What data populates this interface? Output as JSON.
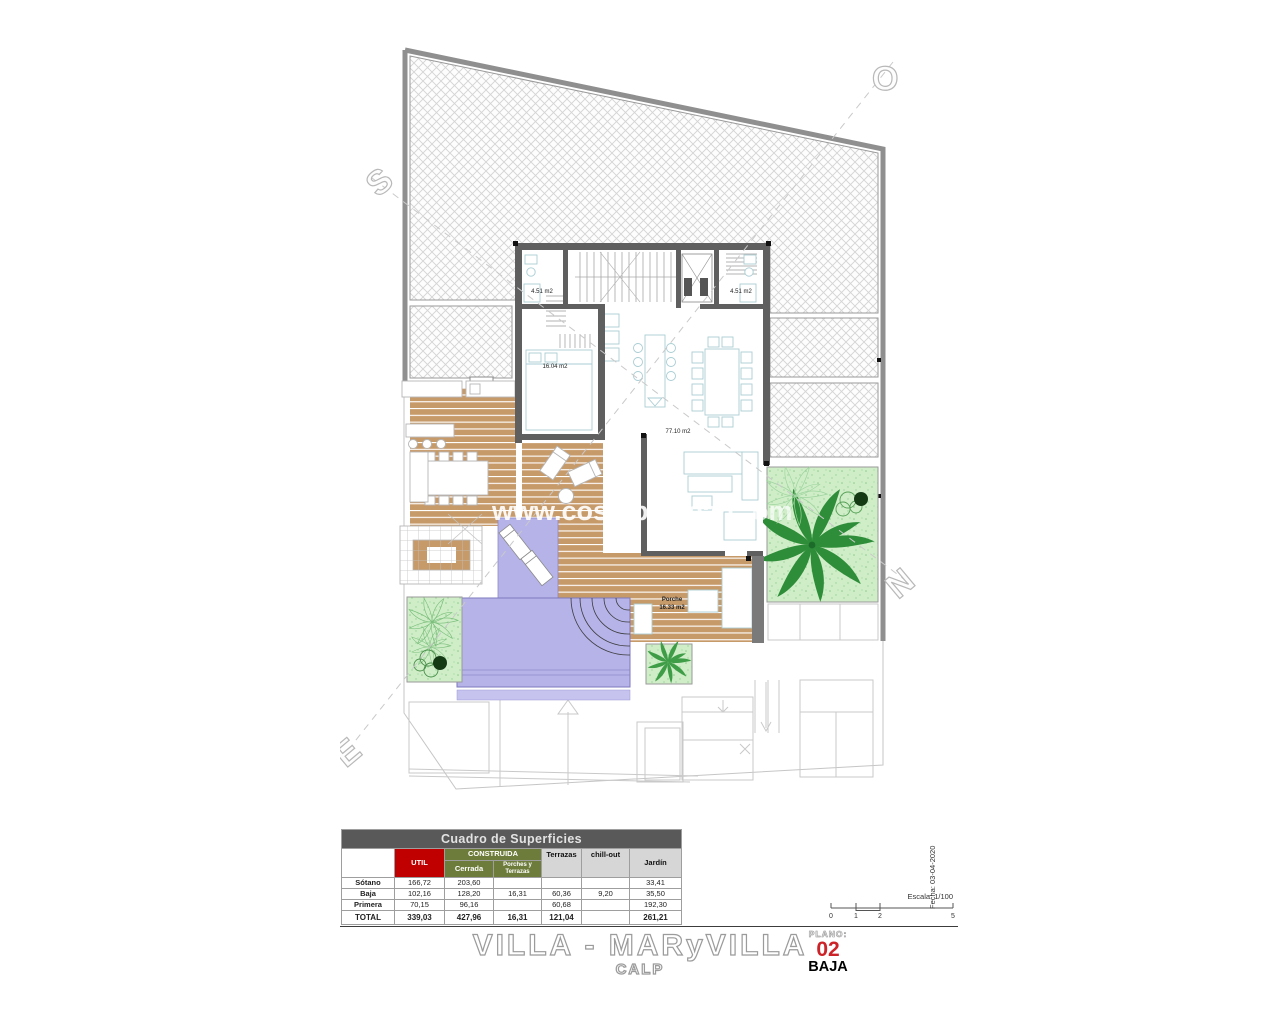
{
  "plan": {
    "compass": {
      "s": "S",
      "o": "O",
      "n": "N",
      "e": "E"
    },
    "labels": {
      "bath_left": "4.51 m2",
      "bath_right": "4.51 m2",
      "bedroom": "16.04 m2",
      "living": "77.10 m2",
      "porch_name": "Porche",
      "porch_area": "16.33 m2"
    },
    "watermark": {
      "part1": "www.costablancah",
      "part2": "om"
    }
  },
  "table": {
    "title": "Cuadro de Superficies",
    "headers": {
      "util": "UTIL",
      "construida": "CONSTRUIDA",
      "cerrada": "Cerrada",
      "porches_line1": "Porches y",
      "porches_line2": "Terrazas",
      "terrazas": "Terrazas",
      "chill_out": "chill-out",
      "jardin": "Jardín"
    },
    "rows": [
      {
        "label": "Sótano",
        "util": "166,72",
        "cerrada": "203,60",
        "porches": "",
        "terrazas": "",
        "chill_out": "",
        "jardin": "33,41"
      },
      {
        "label": "Baja",
        "util": "102,16",
        "cerrada": "128,20",
        "porches": "16,31",
        "terrazas": "60,36",
        "chill_out": "9,20",
        "jardin": "35,50"
      },
      {
        "label": "Primera",
        "util": "70,15",
        "cerrada": "96,16",
        "porches": "",
        "terrazas": "60,68",
        "chill_out": "",
        "jardin": "192,30"
      },
      {
        "label": "TOTAL",
        "util": "339,03",
        "cerrada": "427,96",
        "porches": "16,31",
        "terrazas": "121,04",
        "chill_out": "",
        "jardin": "261,21"
      }
    ]
  },
  "title_block": {
    "project": "VILLA - MARyVILLA",
    "location": "CALP",
    "plano_label": "PLANO:",
    "plano_number": "02",
    "plano_name": "BAJA"
  },
  "scale_bar": {
    "escala": "Escala: 1/100",
    "fecha": "Fecha: 03-04-2020",
    "ticks": [
      "0",
      "1",
      "2",
      "5"
    ]
  },
  "colors": {
    "wall_gray": "#5f5f5f",
    "deck_tan": "#c79a6a",
    "pool_lavender": "#b6b3e9",
    "garden_green": "#cfeec8",
    "palm_green": "#2e8d38",
    "util_red": "#c00000",
    "construida_green": "#6d7c3a",
    "header_gray": "#d6d6d6",
    "table_title_gray": "#595959"
  }
}
